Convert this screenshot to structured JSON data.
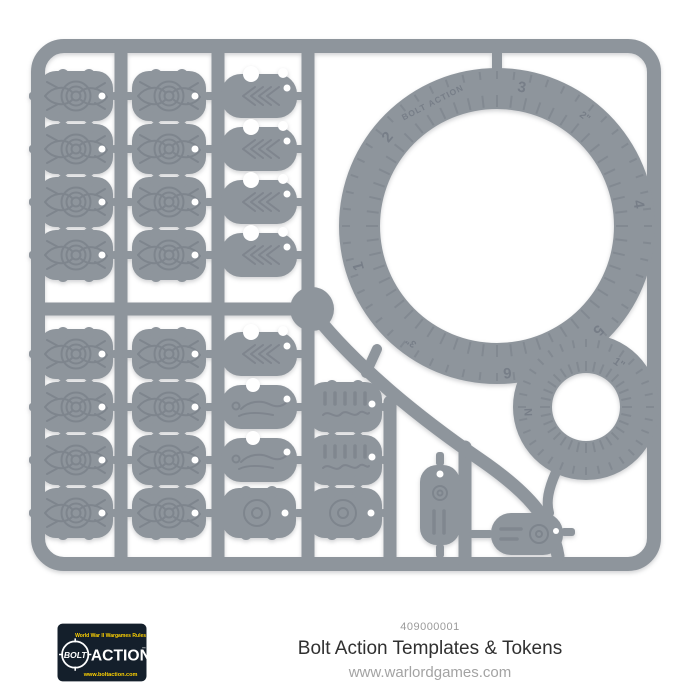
{
  "product": {
    "sku": "409000001",
    "title": "Bolt Action Templates & Tokens",
    "website": "www.warlordgames.com"
  },
  "logo": {
    "tagline": "World War II Wargames Rules",
    "word1": "BOLT",
    "word2": "ACTION",
    "trademark": "™",
    "url": "www.boltaction.com",
    "colors": {
      "background": "#141f2b",
      "accent_yellow": "#ffd200",
      "text": "#ffffff"
    }
  },
  "sprue": {
    "plastic_color": "#8e959c",
    "engraving_color": "#6f7680",
    "contents": {
      "pin_markers": 16,
      "arrow_tokens": 5,
      "prone_tokens": 2,
      "round_tokens": 2,
      "barrier_tokens": 2,
      "tag_token": 1,
      "clock_token": 1,
      "large_ring_template": 1,
      "small_ring_template": 1
    }
  },
  "ring_large": {
    "embossed_logo": "BOLT ACTION",
    "marks": [
      "1",
      "2",
      "2\"",
      "3",
      "3\"",
      "4",
      "5",
      "6"
    ]
  },
  "ring_small": {
    "marks": [
      "1\"",
      "N"
    ]
  }
}
